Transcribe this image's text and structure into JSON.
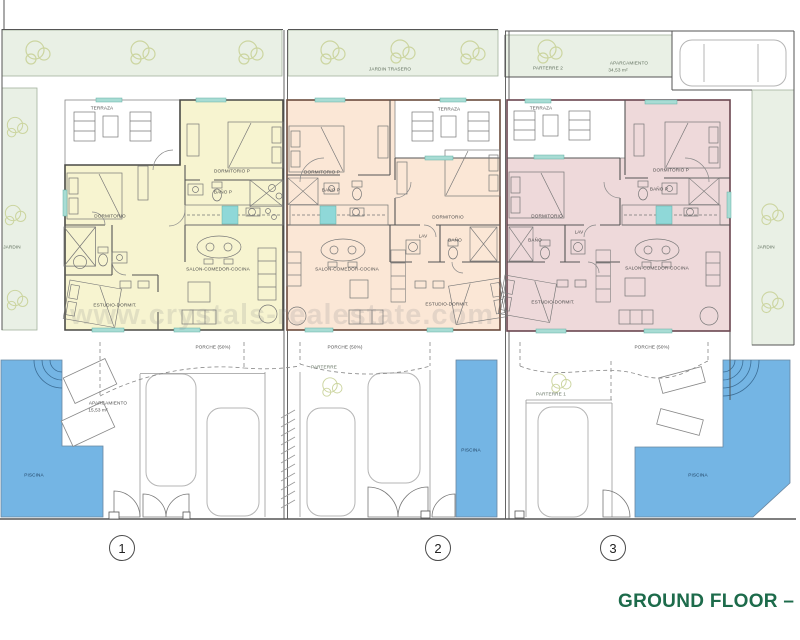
{
  "title": "GROUND FLOOR – PLA",
  "watermark": "www.crystals-realestate.com",
  "site": {
    "jardin_trasero": "JARDIN TRASERO",
    "parterre_2": "PARTERRE 2",
    "aparcamiento_top": "APARCAMIENTO",
    "aparcamiento_top_area": "34,53 m²",
    "jardin_left": "JARDIN",
    "jardin_right": "JARDIN",
    "parterre_mid": "PARTERRE",
    "parterre_1": "PARTERRE 1",
    "aparcamiento_left": "APARCAMIENTO",
    "aparcamiento_left_area": "15,53 m²",
    "piscina_left": "PISCINA",
    "piscina_mid": "PISCINA",
    "piscina_right": "PISCINA"
  },
  "units": [
    {
      "number": "1",
      "rooms": {
        "terraza": "TERRAZA",
        "dormitorio_p": "DORMITORIO P",
        "bano_p": "BAÑO P",
        "dormitorio": "DORMITORIO",
        "salon": "SALON-COMEDOR-COCINA",
        "estudio": "ESTUDIO-DORMIT.",
        "porche": "PORCHE (50%)"
      }
    },
    {
      "number": "2",
      "rooms": {
        "terraza": "TERRAZA",
        "dormitorio_p": "DORMITORIO P",
        "bano_p": "BAÑO P",
        "dormitorio": "DORMITORIO",
        "lav": "LAV",
        "bano": "BAÑO",
        "salon": "SALON-COMEDOR-COCINA",
        "estudio": "ESTUDIO-DORMIT.",
        "porche": "PORCHE (50%)"
      }
    },
    {
      "number": "3",
      "rooms": {
        "terraza": "TERRAZA",
        "dormitorio_p": "DORMITORIO P",
        "bano_p": "BAÑO P",
        "dormitorio": "DORMITORIO",
        "lav": "LAV",
        "bano": "BAÑO",
        "salon": "SALON-COMEDOR-COCINA",
        "estudio": "ESTUDIO-DORMIT.",
        "porche": "PORCHE (50%)"
      }
    }
  ],
  "colors": {
    "unit1": "#f7f4d0",
    "unit2": "#fbe7d6",
    "unit3": "#eed9da",
    "garden": "#e9f0e5",
    "pool": "#74b5e4",
    "title_green": "#1d6b4b",
    "window_teal": "#a8dcd4",
    "kitchen_cyan": "#8fd8d8"
  }
}
